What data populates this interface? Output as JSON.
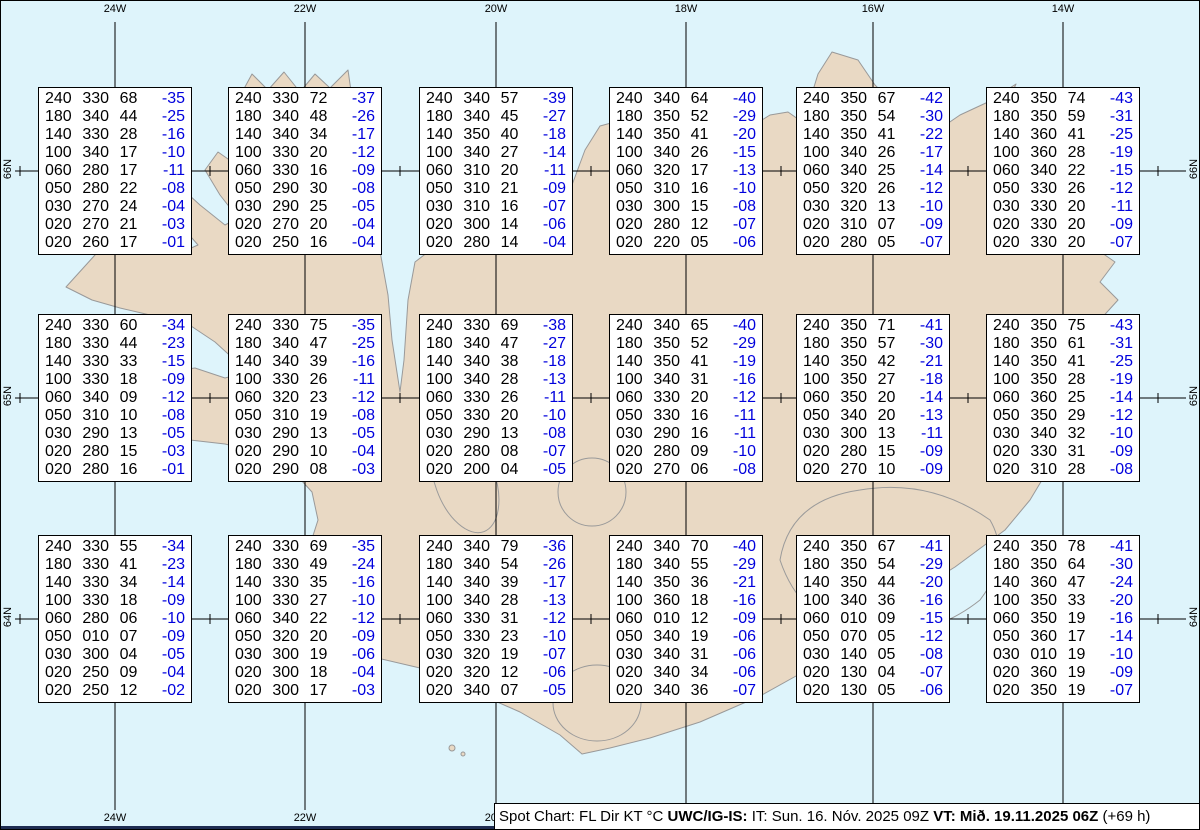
{
  "colors": {
    "sea": "#def4fb",
    "land": "#e9d9c4",
    "coastline": "#999999",
    "grid": "#000000",
    "temp_blue": "#0000dd",
    "bottom_strip": "#1f2d52",
    "box_background": "#ffffff"
  },
  "grid": {
    "lon": {
      "labels": [
        "24W",
        "22W",
        "20W",
        "18W",
        "16W",
        "14W"
      ],
      "x": [
        115,
        305,
        496,
        686,
        873,
        1063
      ]
    },
    "lat": {
      "labels": [
        "66N",
        "65N",
        "64N"
      ],
      "y": [
        171,
        398,
        619
      ]
    },
    "half_ticks_x": [
      20,
      210,
      400,
      591,
      781,
      968,
      1158
    ]
  },
  "stations": [
    {
      "col": 0,
      "row": 0,
      "levels": [
        [
          "240",
          "330",
          "68",
          "-35"
        ],
        [
          "180",
          "340",
          "44",
          "-25"
        ],
        [
          "140",
          "330",
          "28",
          "-16"
        ],
        [
          "100",
          "340",
          "17",
          "-10"
        ],
        [
          "060",
          "280",
          "17",
          "-11"
        ],
        [
          "050",
          "280",
          "22",
          "-08"
        ],
        [
          "030",
          "270",
          "24",
          "-04"
        ],
        [
          "020",
          "270",
          "21",
          "-03"
        ],
        [
          "020",
          "260",
          "17",
          "-01"
        ]
      ]
    },
    {
      "col": 1,
      "row": 0,
      "levels": [
        [
          "240",
          "330",
          "72",
          "-37"
        ],
        [
          "180",
          "340",
          "48",
          "-26"
        ],
        [
          "140",
          "340",
          "34",
          "-17"
        ],
        [
          "100",
          "330",
          "20",
          "-12"
        ],
        [
          "060",
          "330",
          "16",
          "-09"
        ],
        [
          "050",
          "290",
          "30",
          "-08"
        ],
        [
          "030",
          "290",
          "25",
          "-05"
        ],
        [
          "020",
          "270",
          "20",
          "-04"
        ],
        [
          "020",
          "250",
          "16",
          "-04"
        ]
      ]
    },
    {
      "col": 2,
      "row": 0,
      "levels": [
        [
          "240",
          "340",
          "57",
          "-39"
        ],
        [
          "180",
          "340",
          "45",
          "-27"
        ],
        [
          "140",
          "350",
          "40",
          "-18"
        ],
        [
          "100",
          "340",
          "27",
          "-14"
        ],
        [
          "060",
          "310",
          "20",
          "-11"
        ],
        [
          "050",
          "310",
          "21",
          "-09"
        ],
        [
          "030",
          "310",
          "16",
          "-07"
        ],
        [
          "020",
          "300",
          "14",
          "-06"
        ],
        [
          "020",
          "280",
          "14",
          "-04"
        ]
      ]
    },
    {
      "col": 3,
      "row": 0,
      "levels": [
        [
          "240",
          "340",
          "64",
          "-40"
        ],
        [
          "180",
          "350",
          "52",
          "-29"
        ],
        [
          "140",
          "350",
          "41",
          "-20"
        ],
        [
          "100",
          "340",
          "26",
          "-15"
        ],
        [
          "060",
          "320",
          "17",
          "-13"
        ],
        [
          "050",
          "310",
          "16",
          "-10"
        ],
        [
          "030",
          "300",
          "15",
          "-08"
        ],
        [
          "020",
          "280",
          "12",
          "-07"
        ],
        [
          "020",
          "220",
          "05",
          "-06"
        ]
      ]
    },
    {
      "col": 4,
      "row": 0,
      "levels": [
        [
          "240",
          "350",
          "67",
          "-42"
        ],
        [
          "180",
          "350",
          "54",
          "-30"
        ],
        [
          "140",
          "350",
          "41",
          "-22"
        ],
        [
          "100",
          "340",
          "26",
          "-17"
        ],
        [
          "060",
          "340",
          "25",
          "-14"
        ],
        [
          "050",
          "320",
          "26",
          "-12"
        ],
        [
          "030",
          "320",
          "13",
          "-10"
        ],
        [
          "020",
          "310",
          "07",
          "-09"
        ],
        [
          "020",
          "280",
          "05",
          "-07"
        ]
      ]
    },
    {
      "col": 5,
      "row": 0,
      "levels": [
        [
          "240",
          "350",
          "74",
          "-43"
        ],
        [
          "180",
          "350",
          "59",
          "-31"
        ],
        [
          "140",
          "360",
          "41",
          "-25"
        ],
        [
          "100",
          "360",
          "28",
          "-19"
        ],
        [
          "060",
          "340",
          "22",
          "-15"
        ],
        [
          "050",
          "330",
          "26",
          "-12"
        ],
        [
          "030",
          "330",
          "20",
          "-11"
        ],
        [
          "020",
          "330",
          "20",
          "-09"
        ],
        [
          "020",
          "330",
          "20",
          "-07"
        ]
      ]
    },
    {
      "col": 0,
      "row": 1,
      "levels": [
        [
          "240",
          "330",
          "60",
          "-34"
        ],
        [
          "180",
          "330",
          "44",
          "-23"
        ],
        [
          "140",
          "330",
          "33",
          "-15"
        ],
        [
          "100",
          "330",
          "18",
          "-09"
        ],
        [
          "060",
          "340",
          "09",
          "-12"
        ],
        [
          "050",
          "310",
          "10",
          "-08"
        ],
        [
          "030",
          "290",
          "13",
          "-05"
        ],
        [
          "020",
          "280",
          "15",
          "-03"
        ],
        [
          "020",
          "280",
          "16",
          "-01"
        ]
      ]
    },
    {
      "col": 1,
      "row": 1,
      "levels": [
        [
          "240",
          "330",
          "75",
          "-35"
        ],
        [
          "180",
          "340",
          "47",
          "-25"
        ],
        [
          "140",
          "340",
          "39",
          "-16"
        ],
        [
          "100",
          "330",
          "26",
          "-11"
        ],
        [
          "060",
          "320",
          "23",
          "-12"
        ],
        [
          "050",
          "310",
          "19",
          "-08"
        ],
        [
          "030",
          "290",
          "13",
          "-05"
        ],
        [
          "020",
          "290",
          "10",
          "-04"
        ],
        [
          "020",
          "290",
          "08",
          "-03"
        ]
      ]
    },
    {
      "col": 2,
      "row": 1,
      "levels": [
        [
          "240",
          "330",
          "69",
          "-38"
        ],
        [
          "180",
          "340",
          "47",
          "-27"
        ],
        [
          "140",
          "340",
          "38",
          "-18"
        ],
        [
          "100",
          "340",
          "28",
          "-13"
        ],
        [
          "060",
          "330",
          "26",
          "-11"
        ],
        [
          "050",
          "330",
          "20",
          "-10"
        ],
        [
          "030",
          "290",
          "13",
          "-08"
        ],
        [
          "020",
          "280",
          "08",
          "-07"
        ],
        [
          "020",
          "200",
          "04",
          "-05"
        ]
      ]
    },
    {
      "col": 3,
      "row": 1,
      "levels": [
        [
          "240",
          "340",
          "65",
          "-40"
        ],
        [
          "180",
          "350",
          "52",
          "-29"
        ],
        [
          "140",
          "350",
          "41",
          "-19"
        ],
        [
          "100",
          "340",
          "31",
          "-16"
        ],
        [
          "060",
          "330",
          "20",
          "-12"
        ],
        [
          "050",
          "330",
          "16",
          "-11"
        ],
        [
          "030",
          "290",
          "16",
          "-11"
        ],
        [
          "020",
          "280",
          "09",
          "-10"
        ],
        [
          "020",
          "270",
          "06",
          "-08"
        ]
      ]
    },
    {
      "col": 4,
      "row": 1,
      "levels": [
        [
          "240",
          "350",
          "71",
          "-41"
        ],
        [
          "180",
          "350",
          "57",
          "-30"
        ],
        [
          "140",
          "350",
          "42",
          "-21"
        ],
        [
          "100",
          "350",
          "27",
          "-18"
        ],
        [
          "060",
          "350",
          "20",
          "-14"
        ],
        [
          "050",
          "340",
          "20",
          "-13"
        ],
        [
          "030",
          "300",
          "13",
          "-11"
        ],
        [
          "020",
          "280",
          "15",
          "-09"
        ],
        [
          "020",
          "270",
          "10",
          "-09"
        ]
      ]
    },
    {
      "col": 5,
      "row": 1,
      "levels": [
        [
          "240",
          "350",
          "75",
          "-43"
        ],
        [
          "180",
          "350",
          "61",
          "-31"
        ],
        [
          "140",
          "350",
          "41",
          "-25"
        ],
        [
          "100",
          "350",
          "28",
          "-19"
        ],
        [
          "060",
          "360",
          "25",
          "-14"
        ],
        [
          "050",
          "350",
          "29",
          "-12"
        ],
        [
          "030",
          "340",
          "32",
          "-10"
        ],
        [
          "020",
          "330",
          "31",
          "-09"
        ],
        [
          "020",
          "310",
          "28",
          "-08"
        ]
      ]
    },
    {
      "col": 0,
      "row": 2,
      "levels": [
        [
          "240",
          "330",
          "55",
          "-34"
        ],
        [
          "180",
          "330",
          "41",
          "-23"
        ],
        [
          "140",
          "330",
          "34",
          "-14"
        ],
        [
          "100",
          "330",
          "18",
          "-09"
        ],
        [
          "060",
          "280",
          "06",
          "-10"
        ],
        [
          "050",
          "010",
          "07",
          "-09"
        ],
        [
          "030",
          "300",
          "04",
          "-05"
        ],
        [
          "020",
          "250",
          "09",
          "-04"
        ],
        [
          "020",
          "250",
          "12",
          "-02"
        ]
      ]
    },
    {
      "col": 1,
      "row": 2,
      "levels": [
        [
          "240",
          "330",
          "69",
          "-35"
        ],
        [
          "180",
          "330",
          "49",
          "-24"
        ],
        [
          "140",
          "330",
          "35",
          "-16"
        ],
        [
          "100",
          "330",
          "27",
          "-10"
        ],
        [
          "060",
          "340",
          "22",
          "-12"
        ],
        [
          "050",
          "320",
          "20",
          "-09"
        ],
        [
          "030",
          "300",
          "19",
          "-06"
        ],
        [
          "020",
          "300",
          "18",
          "-04"
        ],
        [
          "020",
          "300",
          "17",
          "-03"
        ]
      ]
    },
    {
      "col": 2,
      "row": 2,
      "levels": [
        [
          "240",
          "340",
          "79",
          "-36"
        ],
        [
          "180",
          "340",
          "54",
          "-26"
        ],
        [
          "140",
          "340",
          "39",
          "-17"
        ],
        [
          "100",
          "340",
          "28",
          "-13"
        ],
        [
          "060",
          "330",
          "31",
          "-12"
        ],
        [
          "050",
          "330",
          "23",
          "-10"
        ],
        [
          "030",
          "320",
          "19",
          "-07"
        ],
        [
          "020",
          "320",
          "12",
          "-06"
        ],
        [
          "020",
          "340",
          "07",
          "-05"
        ]
      ]
    },
    {
      "col": 3,
      "row": 2,
      "levels": [
        [
          "240",
          "340",
          "70",
          "-40"
        ],
        [
          "180",
          "340",
          "55",
          "-29"
        ],
        [
          "140",
          "350",
          "36",
          "-21"
        ],
        [
          "100",
          "360",
          "18",
          "-16"
        ],
        [
          "060",
          "010",
          "12",
          "-09"
        ],
        [
          "050",
          "340",
          "19",
          "-06"
        ],
        [
          "030",
          "340",
          "31",
          "-06"
        ],
        [
          "020",
          "340",
          "34",
          "-06"
        ],
        [
          "020",
          "340",
          "36",
          "-07"
        ]
      ]
    },
    {
      "col": 4,
      "row": 2,
      "levels": [
        [
          "240",
          "350",
          "67",
          "-41"
        ],
        [
          "180",
          "350",
          "54",
          "-29"
        ],
        [
          "140",
          "350",
          "44",
          "-20"
        ],
        [
          "100",
          "340",
          "36",
          "-16"
        ],
        [
          "060",
          "010",
          "09",
          "-15"
        ],
        [
          "050",
          "070",
          "05",
          "-12"
        ],
        [
          "030",
          "140",
          "05",
          "-08"
        ],
        [
          "020",
          "130",
          "04",
          "-07"
        ],
        [
          "020",
          "130",
          "05",
          "-06"
        ]
      ]
    },
    {
      "col": 5,
      "row": 2,
      "levels": [
        [
          "240",
          "350",
          "78",
          "-41"
        ],
        [
          "180",
          "350",
          "64",
          "-30"
        ],
        [
          "140",
          "360",
          "47",
          "-24"
        ],
        [
          "100",
          "350",
          "33",
          "-20"
        ],
        [
          "060",
          "350",
          "19",
          "-16"
        ],
        [
          "050",
          "360",
          "17",
          "-14"
        ],
        [
          "030",
          "010",
          "19",
          "-10"
        ],
        [
          "020",
          "360",
          "19",
          "-09"
        ],
        [
          "020",
          "350",
          "19",
          "-07"
        ]
      ]
    }
  ],
  "footer": {
    "segments": [
      {
        "text": "Spot Chart: FL Dir KT °C ",
        "bold": false
      },
      {
        "text": "UWC/IG-IS:",
        "bold": true
      },
      {
        "text": " IT: Sun. 16. Nóv. 2025 09Z ",
        "bold": false
      },
      {
        "text": "VT: Mið. 19.11.2025 06Z",
        "bold": true
      },
      {
        "text": " (+69 h)",
        "bold": false
      }
    ]
  }
}
